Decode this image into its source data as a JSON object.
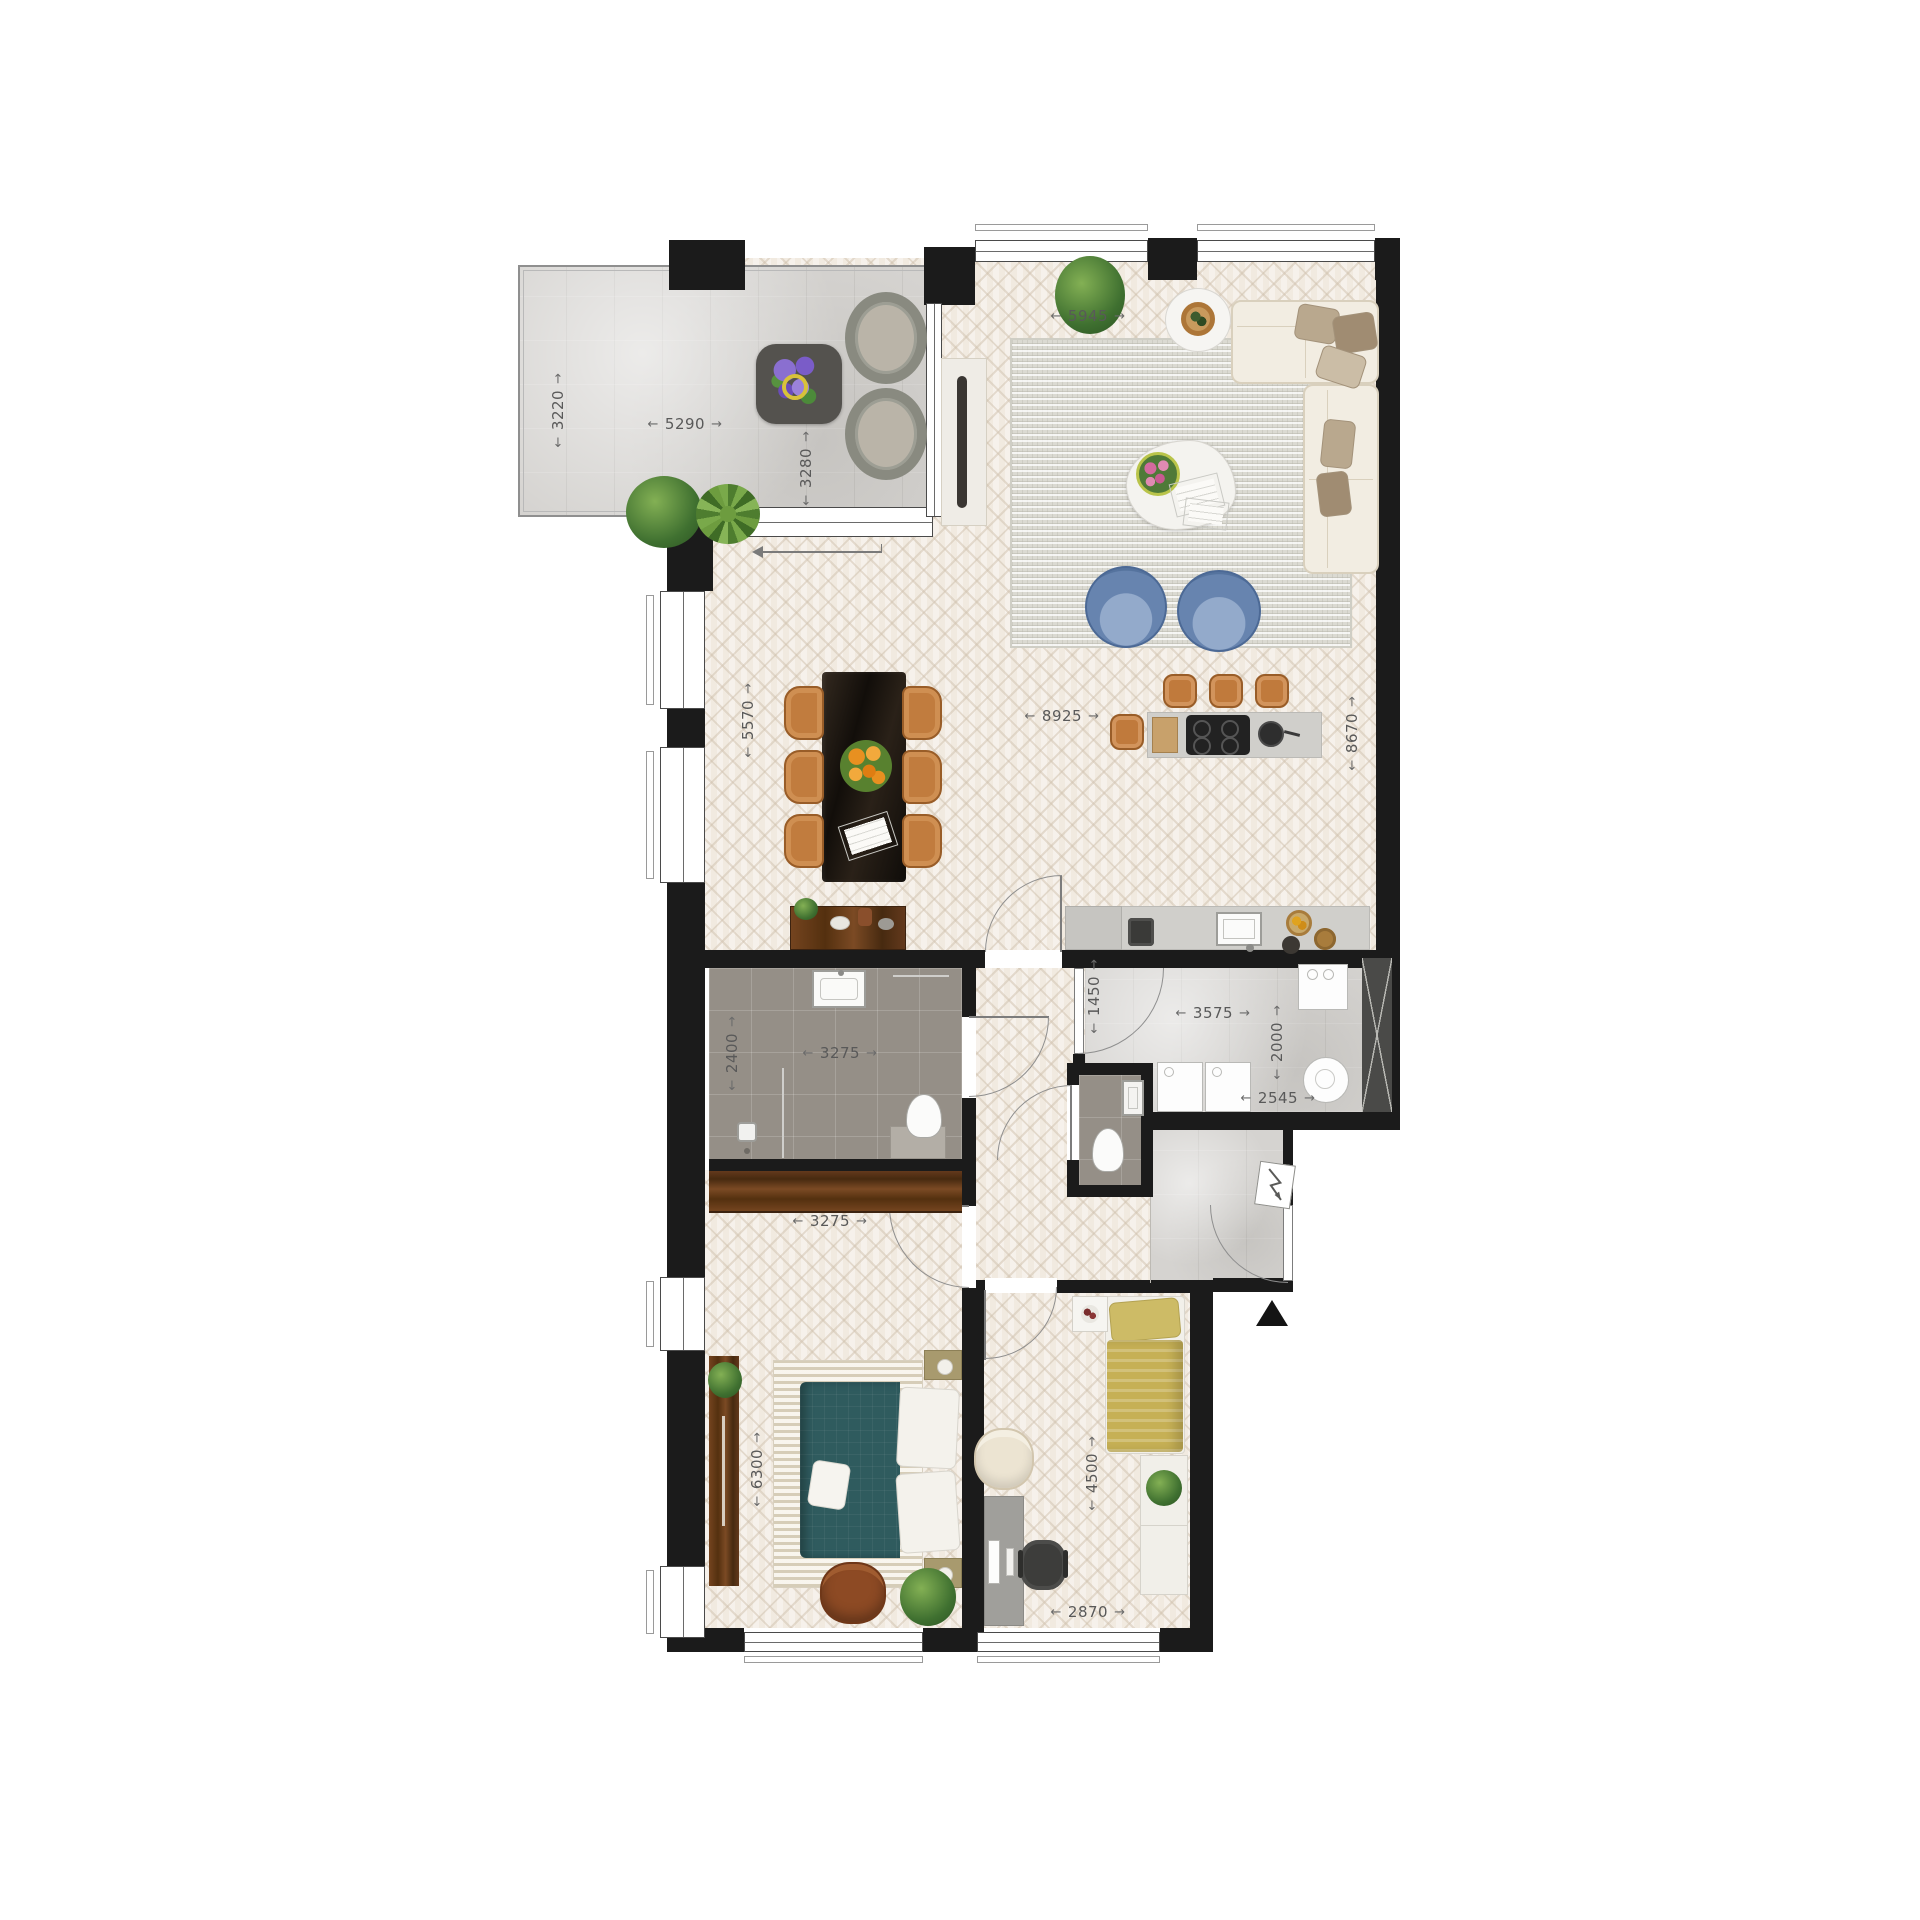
{
  "plan": {
    "type": "apartment-floor-plan",
    "colors": {
      "wall": "#1b1b1b",
      "wood_floor": "#f1eae0",
      "concrete": "#d5d3d0",
      "bathroom_tile": "#958f87",
      "dimension_text": "#595959",
      "teal_bed": "#2f5b5e",
      "olive_bed": "#c6b055",
      "blue_chair": "#6784af",
      "caramel_chair": "#c17c3e",
      "walnut": "#63391c",
      "cream_sofa": "#f2ede2"
    },
    "entrance": {
      "symbol": "triangle-up"
    },
    "dimensions": [
      {
        "value": "3220",
        "x": 558,
        "y": 410,
        "vertical": true,
        "area": "balcony-depth"
      },
      {
        "value": "5290",
        "x": 685,
        "y": 424,
        "vertical": false,
        "area": "balcony-width"
      },
      {
        "value": "3280",
        "x": 806,
        "y": 468,
        "vertical": true,
        "area": "balcony-right-depth"
      },
      {
        "value": "5945",
        "x": 1088,
        "y": 316,
        "vertical": false,
        "area": "living-width"
      },
      {
        "value": "8925",
        "x": 1062,
        "y": 716,
        "vertical": false,
        "area": "living-length"
      },
      {
        "value": "5570",
        "x": 748,
        "y": 720,
        "vertical": true,
        "area": "dining-depth"
      },
      {
        "value": "8670",
        "x": 1352,
        "y": 733,
        "vertical": true,
        "area": "living-depth"
      },
      {
        "value": "2400",
        "x": 732,
        "y": 1053,
        "vertical": true,
        "area": "bathroom-depth"
      },
      {
        "value": "3275",
        "x": 840,
        "y": 1053,
        "vertical": false,
        "area": "bathroom-width"
      },
      {
        "value": "1450",
        "x": 1094,
        "y": 996,
        "vertical": true,
        "area": "hall-width"
      },
      {
        "value": "3575",
        "x": 1213,
        "y": 1013,
        "vertical": false,
        "area": "utility-width"
      },
      {
        "value": "2000",
        "x": 1277,
        "y": 1042,
        "vertical": true,
        "area": "utility-depth"
      },
      {
        "value": "2545",
        "x": 1278,
        "y": 1098,
        "vertical": false,
        "area": "utility-niche-width"
      },
      {
        "value": "3275",
        "x": 830,
        "y": 1221,
        "vertical": false,
        "area": "bedroom1-width"
      },
      {
        "value": "6300",
        "x": 757,
        "y": 1469,
        "vertical": true,
        "area": "bedroom1-depth"
      },
      {
        "value": "4500",
        "x": 1092,
        "y": 1473,
        "vertical": true,
        "area": "bedroom2-depth"
      },
      {
        "value": "2870",
        "x": 1088,
        "y": 1612,
        "vertical": false,
        "area": "bedroom2-width"
      }
    ]
  }
}
